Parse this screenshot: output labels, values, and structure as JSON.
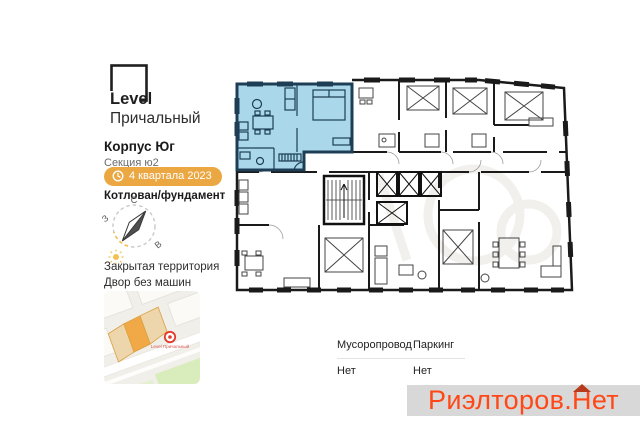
{
  "sidebar": {
    "logo": {
      "brand": "Level",
      "project": "Причальный"
    },
    "building": "Корпус Юг",
    "section": "Секция ю2",
    "completion_badge": "4 квартала 2023",
    "construction_stage": "Котлован/фундамент",
    "compass": {
      "north": "С",
      "west": "З",
      "east": "В"
    },
    "features": [
      "Закрытая территория",
      "Двор без машин"
    ],
    "map_marker_label": "Level Причальный"
  },
  "plan": {
    "highlight_fill": "#aad8ea",
    "highlight_wall": "#1d3e54",
    "wall_color": "#1a1a1a"
  },
  "details": {
    "col1_label": "Мусоропровод",
    "col1_value": "Нет",
    "col2_label": "Паркинг",
    "col2_value": "Нет"
  },
  "footer": {
    "logo_part1": "Риэлторов.",
    "logo_letter": "Н",
    "logo_part3": "ет",
    "logo_color": "#ff4718",
    "roof_color": "#b8391b"
  }
}
